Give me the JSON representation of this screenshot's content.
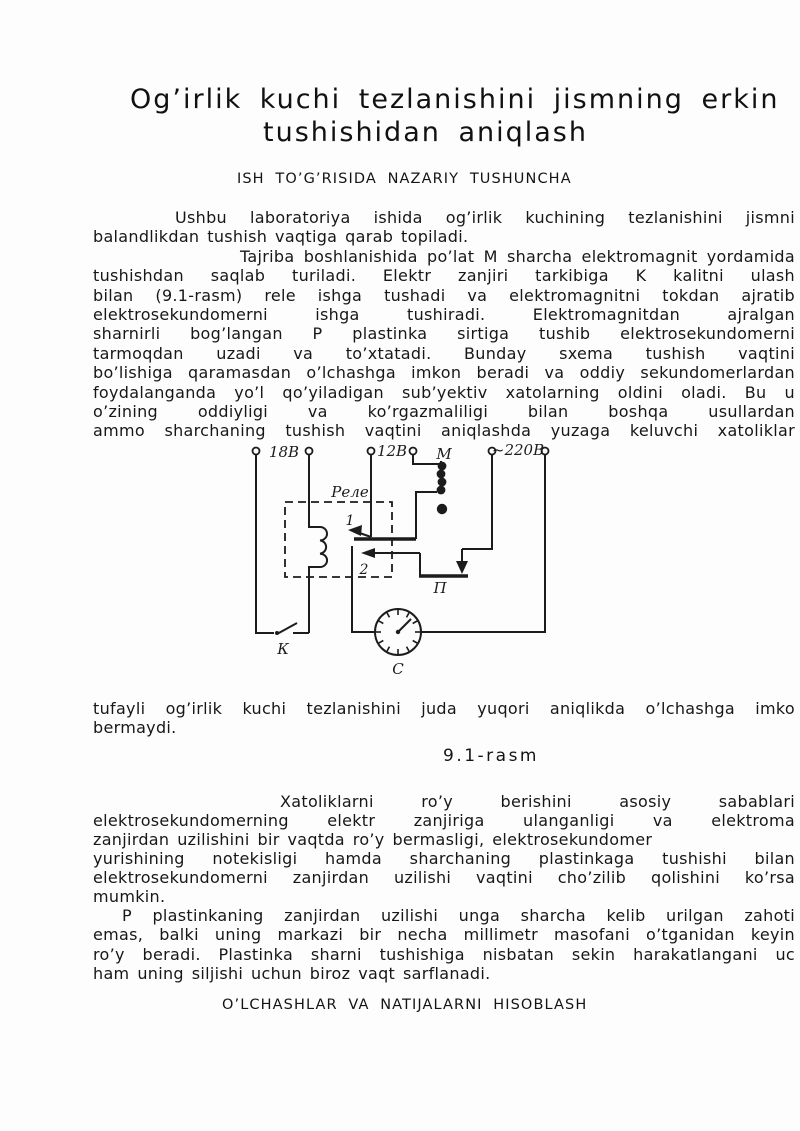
{
  "page": {
    "title_line1": "Og’irlik kuchi tezlanishini jismning erkin",
    "title_line2": "tushishidan aniqlash",
    "section_heading": "ISH TO’G’RISIDA NAZARIY TUSHUNCHA",
    "figure_caption": "9.1-rasm",
    "results_heading": "O’LCHASHLAR VA NATIJALARNI HISOBLASH"
  },
  "paragraph1": {
    "lines": [
      "Ushbu laboratoriya ishida og’irlik kuchining tezlanishini jismni",
      "balandlikdan tushish vaqtiga qarab topiladi.",
      "Tajriba boshlanishida po’lat M sharcha elektromagnit yordamida",
      "tushishdan saqlab turiladi. Elektr zanjiri tarkibiga K kalitni ulash",
      "bilan (9.1-rasm) rele ishga tushadi va elektromagnitni tokdan ajratib",
      "elektrosekundomerni ishga tushiradi. Elektromagnitdan ajralgan",
      "sharnirli bog’langan P plastinka sirtiga tushib elektrosekundomerni",
      "tarmoqdan uzadi va to’xtatadi. Bunday sxema tushish vaqtini",
      "bo’lishiga qaramasdan o’lchashga imkon beradi va oddiy sekundomerlardan",
      "foydalanganda yo’l qo’yiladigan sub’yektiv xatolarning oldini oladi. Bu u",
      "o’zining oddiyligi va ko’rgazmaliligi bilan boshqa usullardan",
      "ammo sharchaning tushish vaqtini aniqlashda yuzaga keluvchi xatoliklar"
    ]
  },
  "paragraph1_cont": {
    "lines": [
      "tufayli og’irlik kuchi tezlanishini juda yuqori aniqlikda o’lchashga imko",
      "bermaydi."
    ]
  },
  "paragraph2": {
    "lines": [
      "Xatoliklarni ro’y berishini asosiy sabablari",
      "elektrosekundomerning elektr zanjiriga ulanganligi va elektroma",
      "zanjirdan uzilishini bir vaqtda ro’y bermasligi, elektrosekundomer",
      "yurishining notekisligi hamda sharchaning plastinkaga tushishi bilan",
      "elektrosekundomerni zanjirdan uzilishi vaqtini cho’zilib qolishini ko’rsa",
      "mumkin."
    ]
  },
  "paragraph3": {
    "lines": [
      "P plastinkaning zanjirdan uzilishi unga sharcha kelib urilgan zahoti",
      "emas, balki uning markazi bir necha millimetr masofani o’tganidan keyin",
      "ro’y beradi. Plastinka sharni tushishiga nisbatan sekin harakatlangani uc",
      "ham uning siljishi uchun biroz vaqt sarflanadi."
    ]
  },
  "figure": {
    "labels": {
      "v18": "18В",
      "v12": "12В",
      "v220": "~220В",
      "magnet": "М",
      "relay": "Реле",
      "contact1": "1",
      "contact2": "2",
      "plate": "П",
      "switch": "К",
      "clock": "С"
    }
  }
}
